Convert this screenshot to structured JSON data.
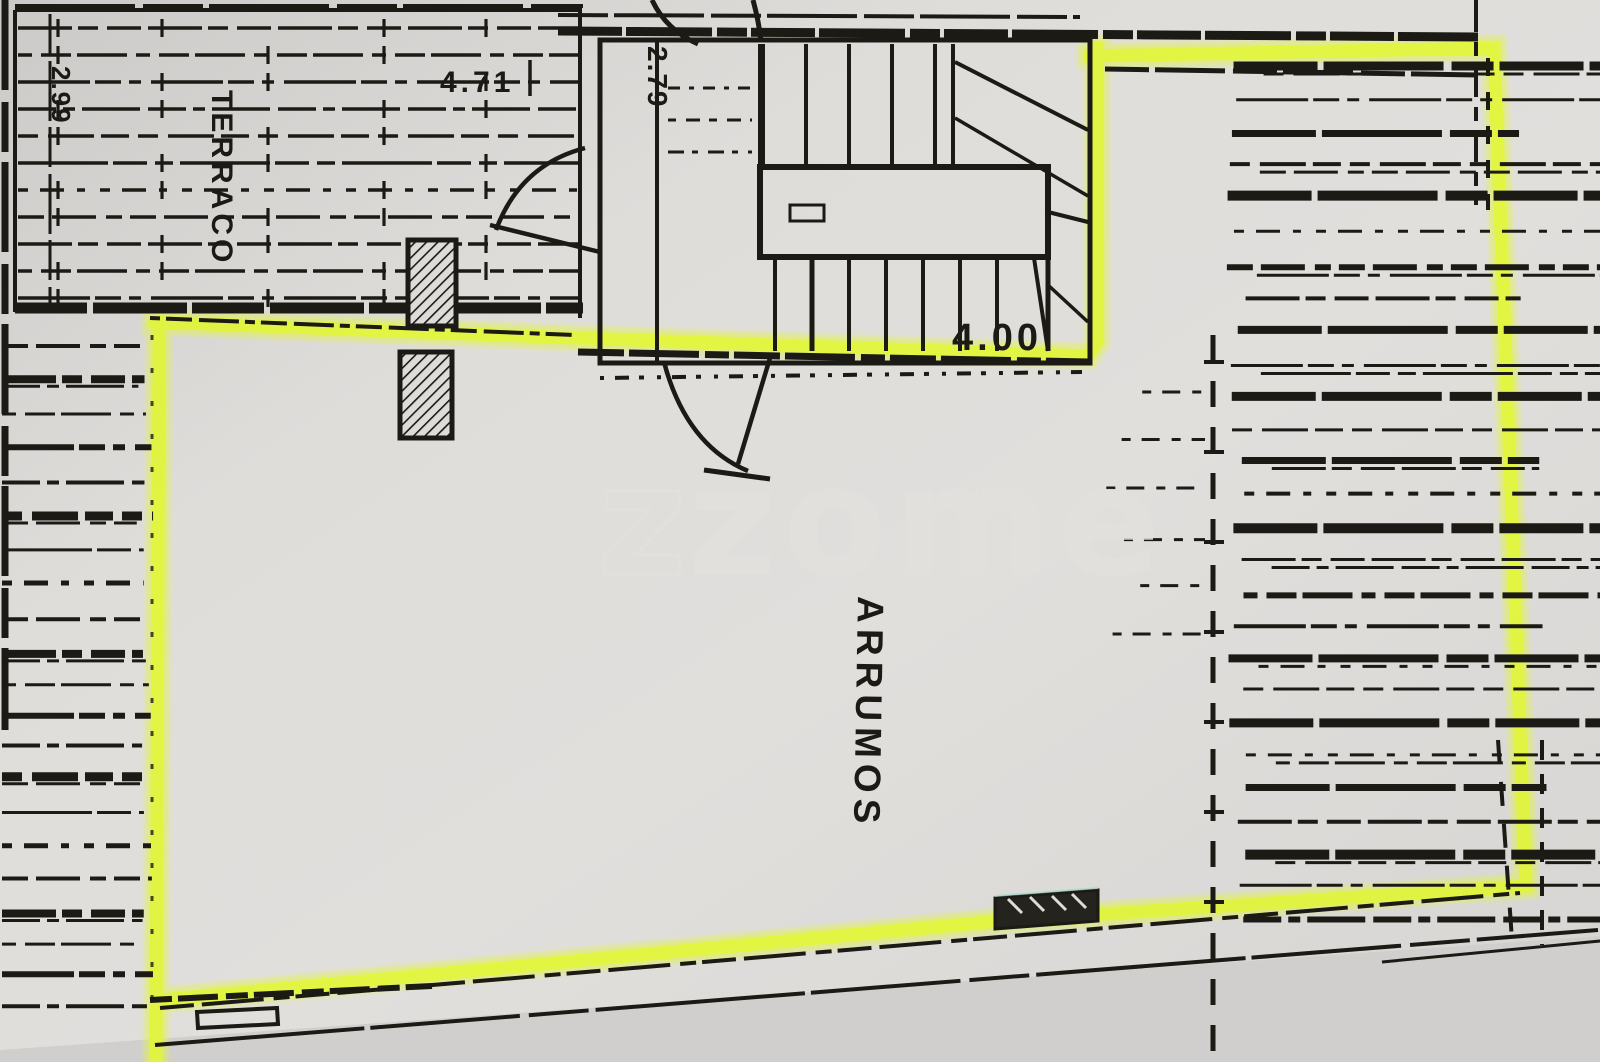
{
  "plan": {
    "labels": {
      "terrace": "TERRACO",
      "room": "ARRUMOS"
    },
    "dimensions": {
      "terrace_width": "4.71",
      "stair_width": "2.79",
      "stair_depth": "4.00",
      "terrace_side": "2.99"
    },
    "watermark": {
      "z_outline": "z",
      "text": "zome",
      "reg": "®"
    },
    "colors": {
      "highlight": "#e2f53d",
      "ink": "#1b1a14",
      "paper": "#dbd9d6",
      "watermark": "#e3e1dd"
    }
  }
}
